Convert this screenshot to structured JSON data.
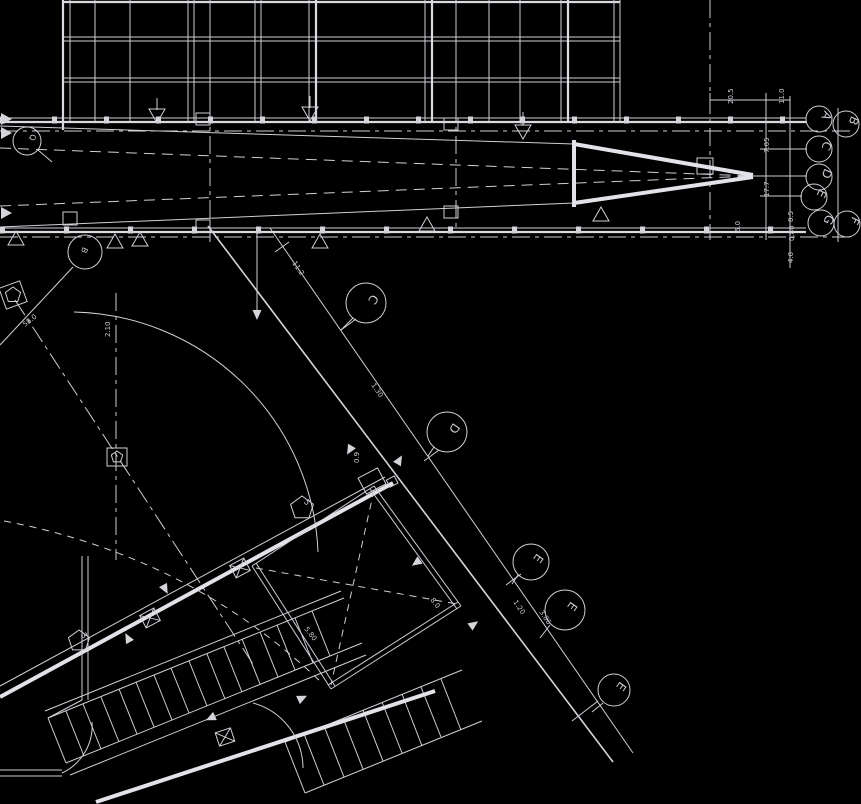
{
  "drawing": {
    "type": "architectural-floor-plan-cad",
    "background_color": "#000000",
    "line_color": "#d2d3d8",
    "grid_bubbles_right": [
      {
        "label": "A",
        "x": 819,
        "y": 119
      },
      {
        "label": "B",
        "x": 846,
        "y": 124
      },
      {
        "label": "C",
        "x": 819,
        "y": 149
      },
      {
        "label": "D",
        "x": 819,
        "y": 177
      },
      {
        "label": "E",
        "x": 814,
        "y": 197
      },
      {
        "label": "G",
        "x": 821,
        "y": 223
      },
      {
        "label": "F",
        "x": 847,
        "y": 224
      }
    ],
    "grid_bubbles_diag": [
      {
        "label": "C",
        "x": 366,
        "y": 303
      },
      {
        "label": "D",
        "x": 447,
        "y": 432
      },
      {
        "label": "E",
        "x": 531,
        "y": 562
      },
      {
        "label": "E",
        "x": 565,
        "y": 610
      },
      {
        "label": "E",
        "x": 614,
        "y": 690
      }
    ],
    "grid_bubbles_left": [
      {
        "label": "Q",
        "x": 27,
        "y": 141
      },
      {
        "label": "B",
        "x": 85,
        "y": 252
      }
    ],
    "keynotes": [
      {
        "label": "5",
        "x": 302,
        "y": 508
      },
      {
        "label": "3",
        "x": 79,
        "y": 641
      }
    ],
    "dimensions": [
      {
        "text": "20.5",
        "x": 733,
        "y": 104,
        "rot": -90
      },
      {
        "text": "11.0",
        "x": 784,
        "y": 104,
        "rot": -90
      },
      {
        "text": "7.05",
        "x": 769,
        "y": 153,
        "rot": -90
      },
      {
        "text": "17.7",
        "x": 769,
        "y": 197,
        "rot": -90
      },
      {
        "text": "8.5",
        "x": 793,
        "y": 222,
        "rot": -90
      },
      {
        "text": "5.0",
        "x": 740,
        "y": 232,
        "rot": -90
      },
      {
        "text": "0.80",
        "x": 794,
        "y": 241,
        "rot": -90
      },
      {
        "text": "4.0",
        "x": 793,
        "y": 263,
        "rot": -90
      },
      {
        "text": "11.2",
        "x": 292,
        "y": 263,
        "rot": 56
      },
      {
        "text": "1.30",
        "x": 371,
        "y": 385,
        "rot": 56
      },
      {
        "text": "1.20",
        "x": 513,
        "y": 602,
        "rot": 56
      },
      {
        "text": "3.86",
        "x": 539,
        "y": 612,
        "rot": 56
      },
      {
        "text": "5.80",
        "x": 304,
        "y": 629,
        "rot": 52
      },
      {
        "text": "58.0",
        "x": 25,
        "y": 327,
        "rot": -38
      },
      {
        "text": "2.10",
        "x": 110,
        "y": 337,
        "rot": -90
      },
      {
        "text": "0.9",
        "x": 359,
        "y": 463,
        "rot": -90
      },
      {
        "text": "8.0",
        "x": 430,
        "y": 600,
        "rot": 52
      }
    ]
  }
}
